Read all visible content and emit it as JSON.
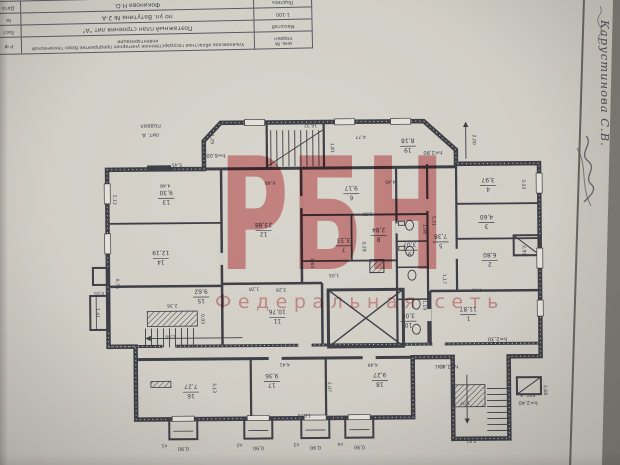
{
  "watermark": {
    "brand": "РБН",
    "subtitle": "Федеральная сеть",
    "color": "#cf484e"
  },
  "title_block": {
    "rows": [
      [
        "Дата",
        "Фокинова Н.О.",
        "Подпись"
      ],
      [
        "№",
        "по ул. Ватутина № 2-А",
        "1:100"
      ],
      [
        "Лист",
        "Поэтажный план строения лит \"А\"",
        "Масштаб"
      ],
      [
        "Р Ф",
        "Ульяновское областное государственное унитарное предприятие Бюро технической инвентаризации",
        "инв. №\nподвал"
      ]
    ]
  },
  "margin": {
    "examiner": "Карустинова С.В."
  },
  "plan": {
    "floor_labels": [
      "подвал",
      "лит. А"
    ],
    "annex_label": "лит. а",
    "rooms": [
      {
        "num": "1",
        "area": "11,87",
        "x": 468,
        "y": 316
      },
      {
        "num": "2",
        "area": "6,80",
        "x": 490,
        "y": 262
      },
      {
        "num": "3",
        "area": "4,60",
        "x": 487,
        "y": 224
      },
      {
        "num": "4",
        "area": "3,97",
        "x": 489,
        "y": 187
      },
      {
        "num": "5",
        "area": "7,38",
        "x": 441,
        "y": 243
      },
      {
        "num": "6",
        "area": "9,17",
        "x": 352,
        "y": 194
      },
      {
        "num": "7",
        "area": "3,33",
        "x": 344,
        "y": 246
      },
      {
        "num": "8",
        "area": "2,84",
        "x": 379,
        "y": 236
      },
      {
        "num": "9",
        "area": "3,07",
        "x": 410,
        "y": 251
      },
      {
        "num": "10",
        "area": "3,08",
        "x": 408,
        "y": 322
      },
      {
        "num": "11",
        "area": "10,76",
        "x": 277,
        "y": 317
      },
      {
        "num": "12",
        "area": "23,88",
        "x": 264,
        "y": 230
      },
      {
        "num": "13",
        "area": "9,30",
        "x": 167,
        "y": 197
      },
      {
        "num": "14",
        "area": "12,19",
        "x": 161,
        "y": 257
      },
      {
        "num": "15",
        "area": "9,62",
        "x": 201,
        "y": 296
      },
      {
        "num": "16",
        "area": "7,27",
        "x": 190,
        "y": 391
      },
      {
        "num": "17",
        "area": "9,36",
        "x": 271,
        "y": 381
      },
      {
        "num": "18",
        "area": "9,27",
        "x": 379,
        "y": 381
      },
      {
        "num": "19",
        "area": "8,18",
        "x": 409,
        "y": 147
      }
    ],
    "heights": [
      {
        "t": "h=6,00",
        "x": 217,
        "y": 153
      },
      {
        "t": "h=2,80",
        "x": 434,
        "y": 152
      },
      {
        "t": "h=2,30",
        "x": 497,
        "y": 339
      },
      {
        "t": "h=2,45",
        "x": 448,
        "y": 366
      },
      {
        "t": "h=2,40",
        "x": 527,
        "y": 403
      }
    ],
    "dims": [
      {
        "t": "16,32",
        "x": 312,
        "y": 124,
        "o": "h"
      },
      {
        "t": "4,77",
        "x": 362,
        "y": 136,
        "o": "h"
      },
      {
        "t": "1,81",
        "x": 332,
        "y": 148,
        "o": "v"
      },
      {
        "t": "1,29",
        "x": 212,
        "y": 138,
        "o": "v"
      },
      {
        "t": "5,45",
        "x": 178,
        "y": 162,
        "o": "h"
      },
      {
        "t": "6,49",
        "x": 271,
        "y": 181,
        "o": "h"
      },
      {
        "t": "4,48",
        "x": 166,
        "y": 183,
        "o": "h"
      },
      {
        "t": "4,45",
        "x": 391,
        "y": 181,
        "o": "h"
      },
      {
        "t": "2,00",
        "x": 474,
        "y": 141,
        "o": "v"
      },
      {
        "t": "3,03",
        "x": 523,
        "y": 186,
        "o": "v"
      },
      {
        "t": "2,95",
        "x": 523,
        "y": 252,
        "o": "v"
      },
      {
        "t": "2,12",
        "x": 114,
        "y": 198,
        "o": "v"
      },
      {
        "t": "5,51",
        "x": 433,
        "y": 222,
        "o": "v"
      },
      {
        "t": "1,90",
        "x": 368,
        "y": 213,
        "o": "h"
      },
      {
        "t": "0,29",
        "x": 363,
        "y": 247,
        "o": "v"
      },
      {
        "t": "1,05",
        "x": 334,
        "y": 274,
        "o": "h"
      },
      {
        "t": "1,63",
        "x": 311,
        "y": 263,
        "o": "v"
      },
      {
        "t": "1,08",
        "x": 424,
        "y": 230,
        "o": "v"
      },
      {
        "t": "1,19",
        "x": 423,
        "y": 306,
        "o": "v"
      },
      {
        "t": "2,36",
        "x": 172,
        "y": 303,
        "o": "h"
      },
      {
        "t": "0,93",
        "x": 201,
        "y": 318,
        "o": "v"
      },
      {
        "t": "1,90",
        "x": 170,
        "y": 334,
        "o": "h"
      },
      {
        "t": "1,28",
        "x": 254,
        "y": 287,
        "o": "h"
      },
      {
        "t": "3,28",
        "x": 281,
        "y": 288,
        "o": "h"
      },
      {
        "t": "4,43",
        "x": 477,
        "y": 290,
        "o": "h"
      },
      {
        "t": "1,17",
        "x": 443,
        "y": 280,
        "o": "v"
      },
      {
        "t": "4,41",
        "x": 284,
        "y": 363,
        "o": "h"
      },
      {
        "t": "4,46",
        "x": 372,
        "y": 364,
        "o": "h"
      },
      {
        "t": "2,07",
        "x": 327,
        "y": 387,
        "o": "v"
      },
      {
        "t": "3,13",
        "x": 212,
        "y": 387,
        "o": "v"
      },
      {
        "t": "13,06",
        "x": 303,
        "y": 414,
        "o": "h"
      },
      {
        "t": "3,41",
        "x": 439,
        "y": 366,
        "o": "h"
      },
      {
        "t": "2,12",
        "x": 506,
        "y": 382,
        "o": "v"
      },
      {
        "t": "1,07",
        "x": 464,
        "y": 403,
        "o": "h"
      },
      {
        "t": "3,81",
        "x": 470,
        "y": 441,
        "o": "h"
      },
      {
        "t": "2,68",
        "x": 543,
        "y": 392,
        "o": "v"
      },
      {
        "t": "1,41",
        "x": 96,
        "y": 311,
        "o": "v"
      },
      {
        "t": "0,55",
        "x": 99,
        "y": 290,
        "o": "h"
      },
      {
        "t": "0,76",
        "x": 116,
        "y": 282,
        "o": "v"
      }
    ],
    "wells": {
      "labels": [
        "п1",
        "п2",
        "п3",
        "п4"
      ],
      "width": "0,90"
    }
  }
}
